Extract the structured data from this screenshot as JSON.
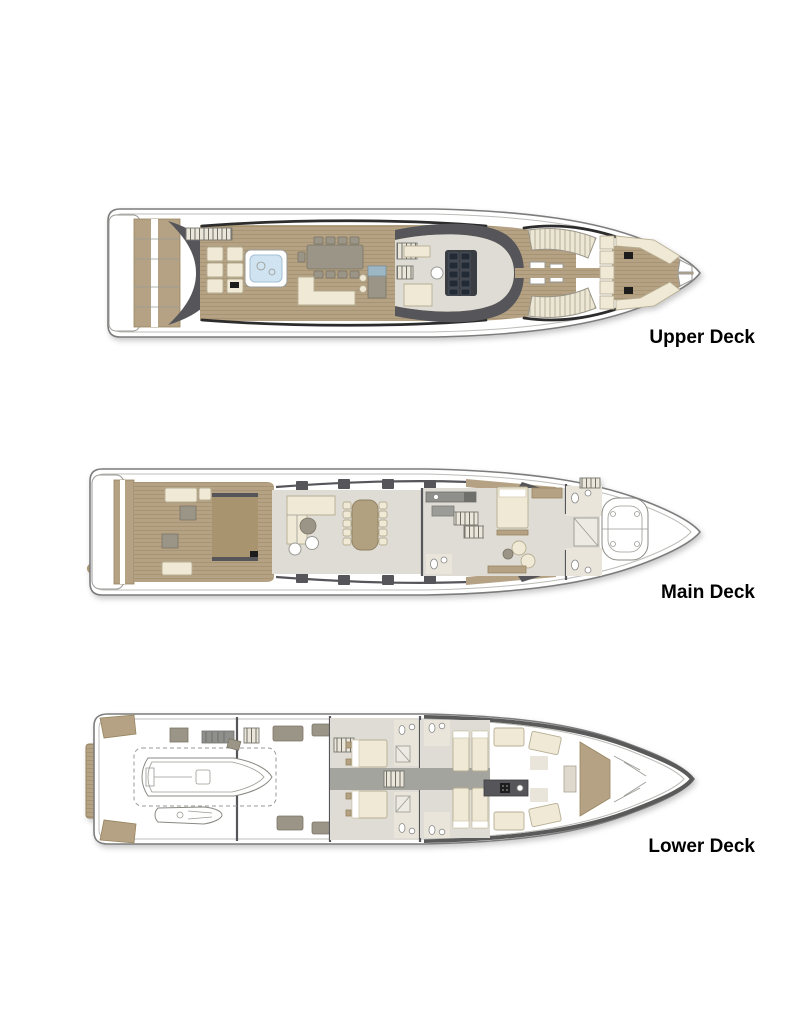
{
  "page": {
    "background_color": "#ffffff",
    "type": "yacht-deck-plan-diagram"
  },
  "colors": {
    "page_bg": "#ffffff",
    "hull_outline": "#7c7c7c",
    "deck_wood": "#b5a284",
    "furniture_cream": "#efe9d6",
    "furniture_gray": "#9b9588",
    "superstructure_dark": "#56565a",
    "interior_floor": "#dedcd4",
    "jacuzzi_water": "#cfe3f0",
    "console_dark": "#3a3d42",
    "label_text": "#000000"
  },
  "decks": [
    {
      "id": "upper-deck",
      "label": "Upper Deck",
      "features": [
        "stern-stairs",
        "sun-loungers",
        "jacuzzi",
        "alfresco-dining-table",
        "sofa",
        "wet-bar",
        "wheelhouse-helm",
        "side-sunpads",
        "foredeck-walkway",
        "bow-seating"
      ]
    },
    {
      "id": "main-deck",
      "label": "Main Deck",
      "features": [
        "passerelle",
        "aft-deck-loungers",
        "salon-sofa",
        "coffee-tables",
        "dining-table",
        "galley",
        "stairs",
        "owner-stateroom-bed",
        "owner-bathroom",
        "bow-sunpad"
      ]
    },
    {
      "id": "lower-deck",
      "label": "Lower Deck",
      "features": [
        "swim-platform",
        "tender-garage",
        "tender",
        "jet-ski",
        "engine-room",
        "twin-engines",
        "guest-double-cabins",
        "guest-twin-cabins",
        "crew-galley",
        "crew-cabins",
        "forepeak"
      ]
    }
  ]
}
